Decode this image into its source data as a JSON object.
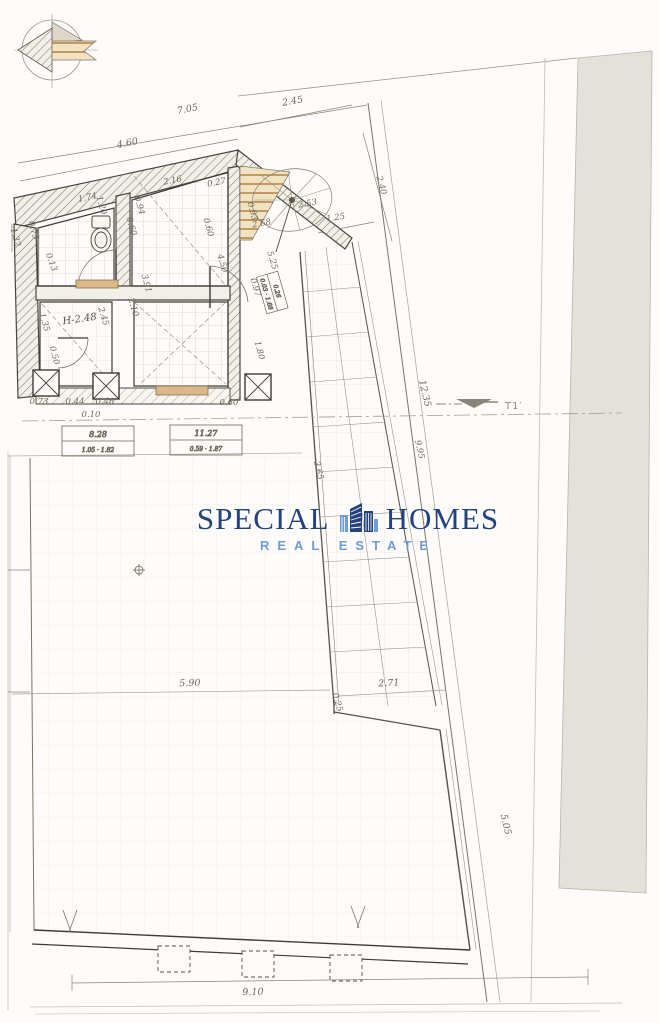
{
  "colors": {
    "watermark_navy": "#24427e",
    "watermark_blue": "#6f9cd4",
    "paper": "#fdfcfa",
    "adjacent_gray": "#e4e1db",
    "pencil_dark": "#3f3b34",
    "pencil_mid": "#7a7468",
    "tan_fixture": "#d9b98a"
  },
  "watermark": {
    "word_left": "SPECIAL",
    "word_right": "HOMES",
    "tagline": "REAL ESTATE",
    "icon": "buildings-icon"
  },
  "section_marker": {
    "label": "T1′"
  },
  "labels": {
    "height": "H-2.48"
  },
  "area_boxes": {
    "b1_top": "8.28",
    "b1_bottom": "1.05 · 1.82",
    "b2_top": "11.27",
    "b2_bottom": "0.59 · 1.87",
    "b3_top": "0.26",
    "b3_bottom": "0.03 · 1.68"
  },
  "dims": [
    "7.05",
    "4.60",
    "2.45",
    "2.40",
    "1.25",
    "2.53",
    "2.68",
    "0.93",
    "2.16",
    "0.27",
    "1.74",
    "1.20",
    "0.94",
    "0.60",
    "0.75",
    "0.60",
    "0.13",
    "4.50",
    "3.91",
    "2.45",
    "1.35",
    "2.10",
    "0.50",
    "0.73",
    "0.44",
    "0.46",
    "0.10",
    "0.60",
    "0.97",
    "5.25",
    "1.80",
    "12.35",
    "9.95",
    "3.65",
    "5.90",
    "2.71",
    "0.25",
    "5.05",
    "9.10",
    "1.32"
  ]
}
